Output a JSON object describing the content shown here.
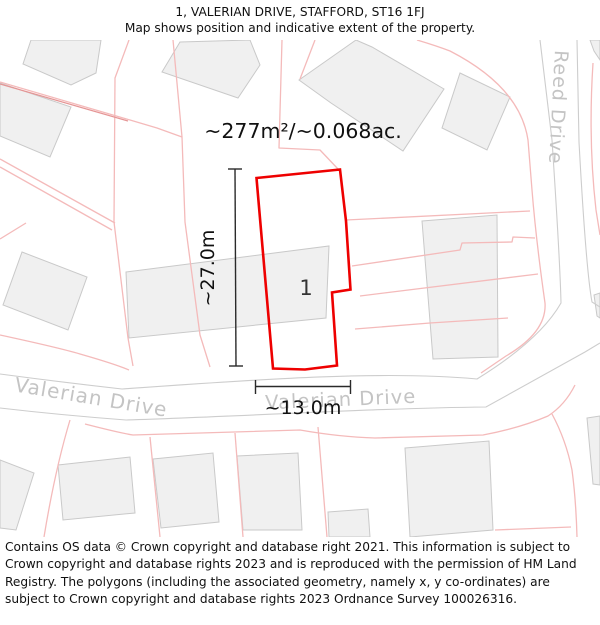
{
  "header": {
    "title": "1, VALERIAN DRIVE, STAFFORD, ST16 1FJ",
    "subtitle": "Map shows position and indicative extent of the property."
  },
  "map": {
    "area_label": "~277m²/~0.068ac.",
    "plot_number": "1",
    "dim_vertical_label": "~27.0m",
    "dim_horizontal_label": "~13.0m",
    "streets": {
      "valerian_left": "Valerian Drive",
      "valerian_right": "Valerian Drive",
      "reed": "Reed Drive"
    },
    "colors": {
      "plot_outline": "#ee0000",
      "parcel_line": "#f4baba",
      "parcel_line_dark": "#e59595",
      "building_fill": "#f0f0f0",
      "building_stroke": "#c9c9c9",
      "road_edge": "#cdcdcd",
      "street_label": "#c4c4c4",
      "dimension_line": "#2a2a2a"
    }
  },
  "footer": {
    "text": "Contains OS data © Crown copyright and database right 2021. This information is subject to Crown copyright and database rights 2023 and is reproduced with the permission of HM Land Registry. The polygons (including the associated geometry, namely x, y co-ordinates) are subject to Crown copyright and database rights 2023 Ordnance Survey 100026316."
  }
}
